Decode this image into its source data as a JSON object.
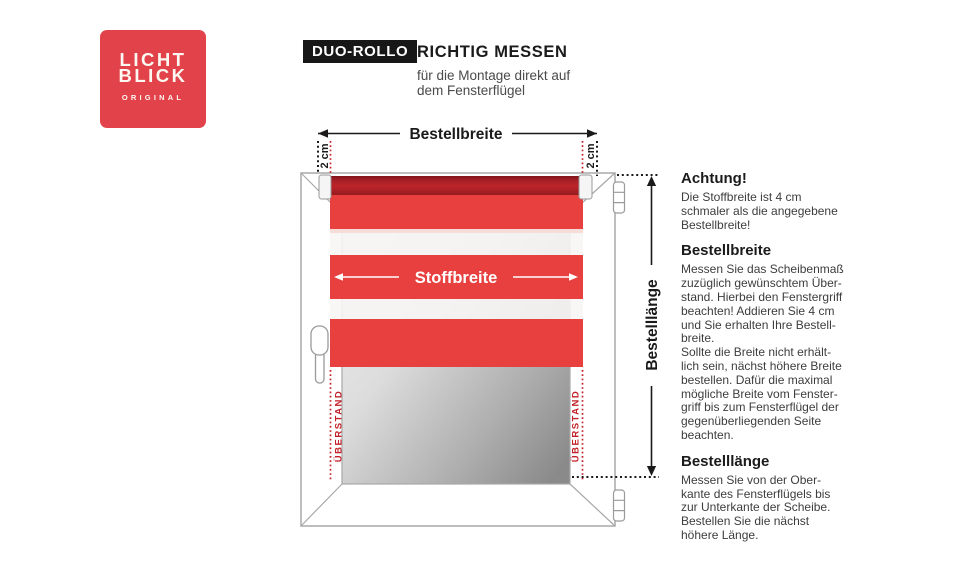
{
  "logo": {
    "line1": "LICHT",
    "line2": "BLICK",
    "subtext": "ORIGINAL",
    "bg_color": "#e2424a"
  },
  "header": {
    "badge": "DUO-ROLLO",
    "title": "RICHTIG MESSEN",
    "subtitle": "für die Montage direkt auf\ndem Fensterflügel"
  },
  "diagram": {
    "bestellbreite_label": "Bestellbreite",
    "gap_left": "2 cm",
    "gap_right": "2 cm",
    "stoffbreite_label": "Stoffbreite",
    "overhang_left": "ÜBERSTAND",
    "overhang_right": "ÜBERSTAND",
    "bestelllaenge_label": "Bestelllänge",
    "colors": {
      "fabric_red": "#e7403f",
      "tube_red": "#bc2529",
      "marker_red": "#c22128",
      "frame_gray": "#a8a8a8",
      "dimension_black": "#1a1a1a"
    }
  },
  "info": {
    "sections": [
      {
        "heading": "Achtung!",
        "body": "Die Stoffbreite ist 4 cm\nschmaler als die angegebene\nBestellbreite!"
      },
      {
        "heading": "Bestellbreite",
        "body": "Messen Sie das Scheibenmaß\nzuzüglich gewünschtem Über-\nstand. Hierbei den Fenstergriff\nbeachten! Addieren Sie 4 cm\nund Sie erhalten Ihre Bestell-\nbreite.\nSollte die Breite nicht erhält-\nlich sein, nächst höhere Breite\nbestellen. Dafür die maximal\nmögliche Breite vom Fenster-\ngriff bis zum Fensterflügel der\ngegenüberliegenden Seite\nbeachten."
      },
      {
        "heading": "Bestelllänge",
        "body": "Messen Sie von der Ober-\nkante des Fensterflügels bis\nzur Unterkante der Scheibe.\nBestellen Sie die nächst\nhöhere Länge."
      }
    ]
  }
}
